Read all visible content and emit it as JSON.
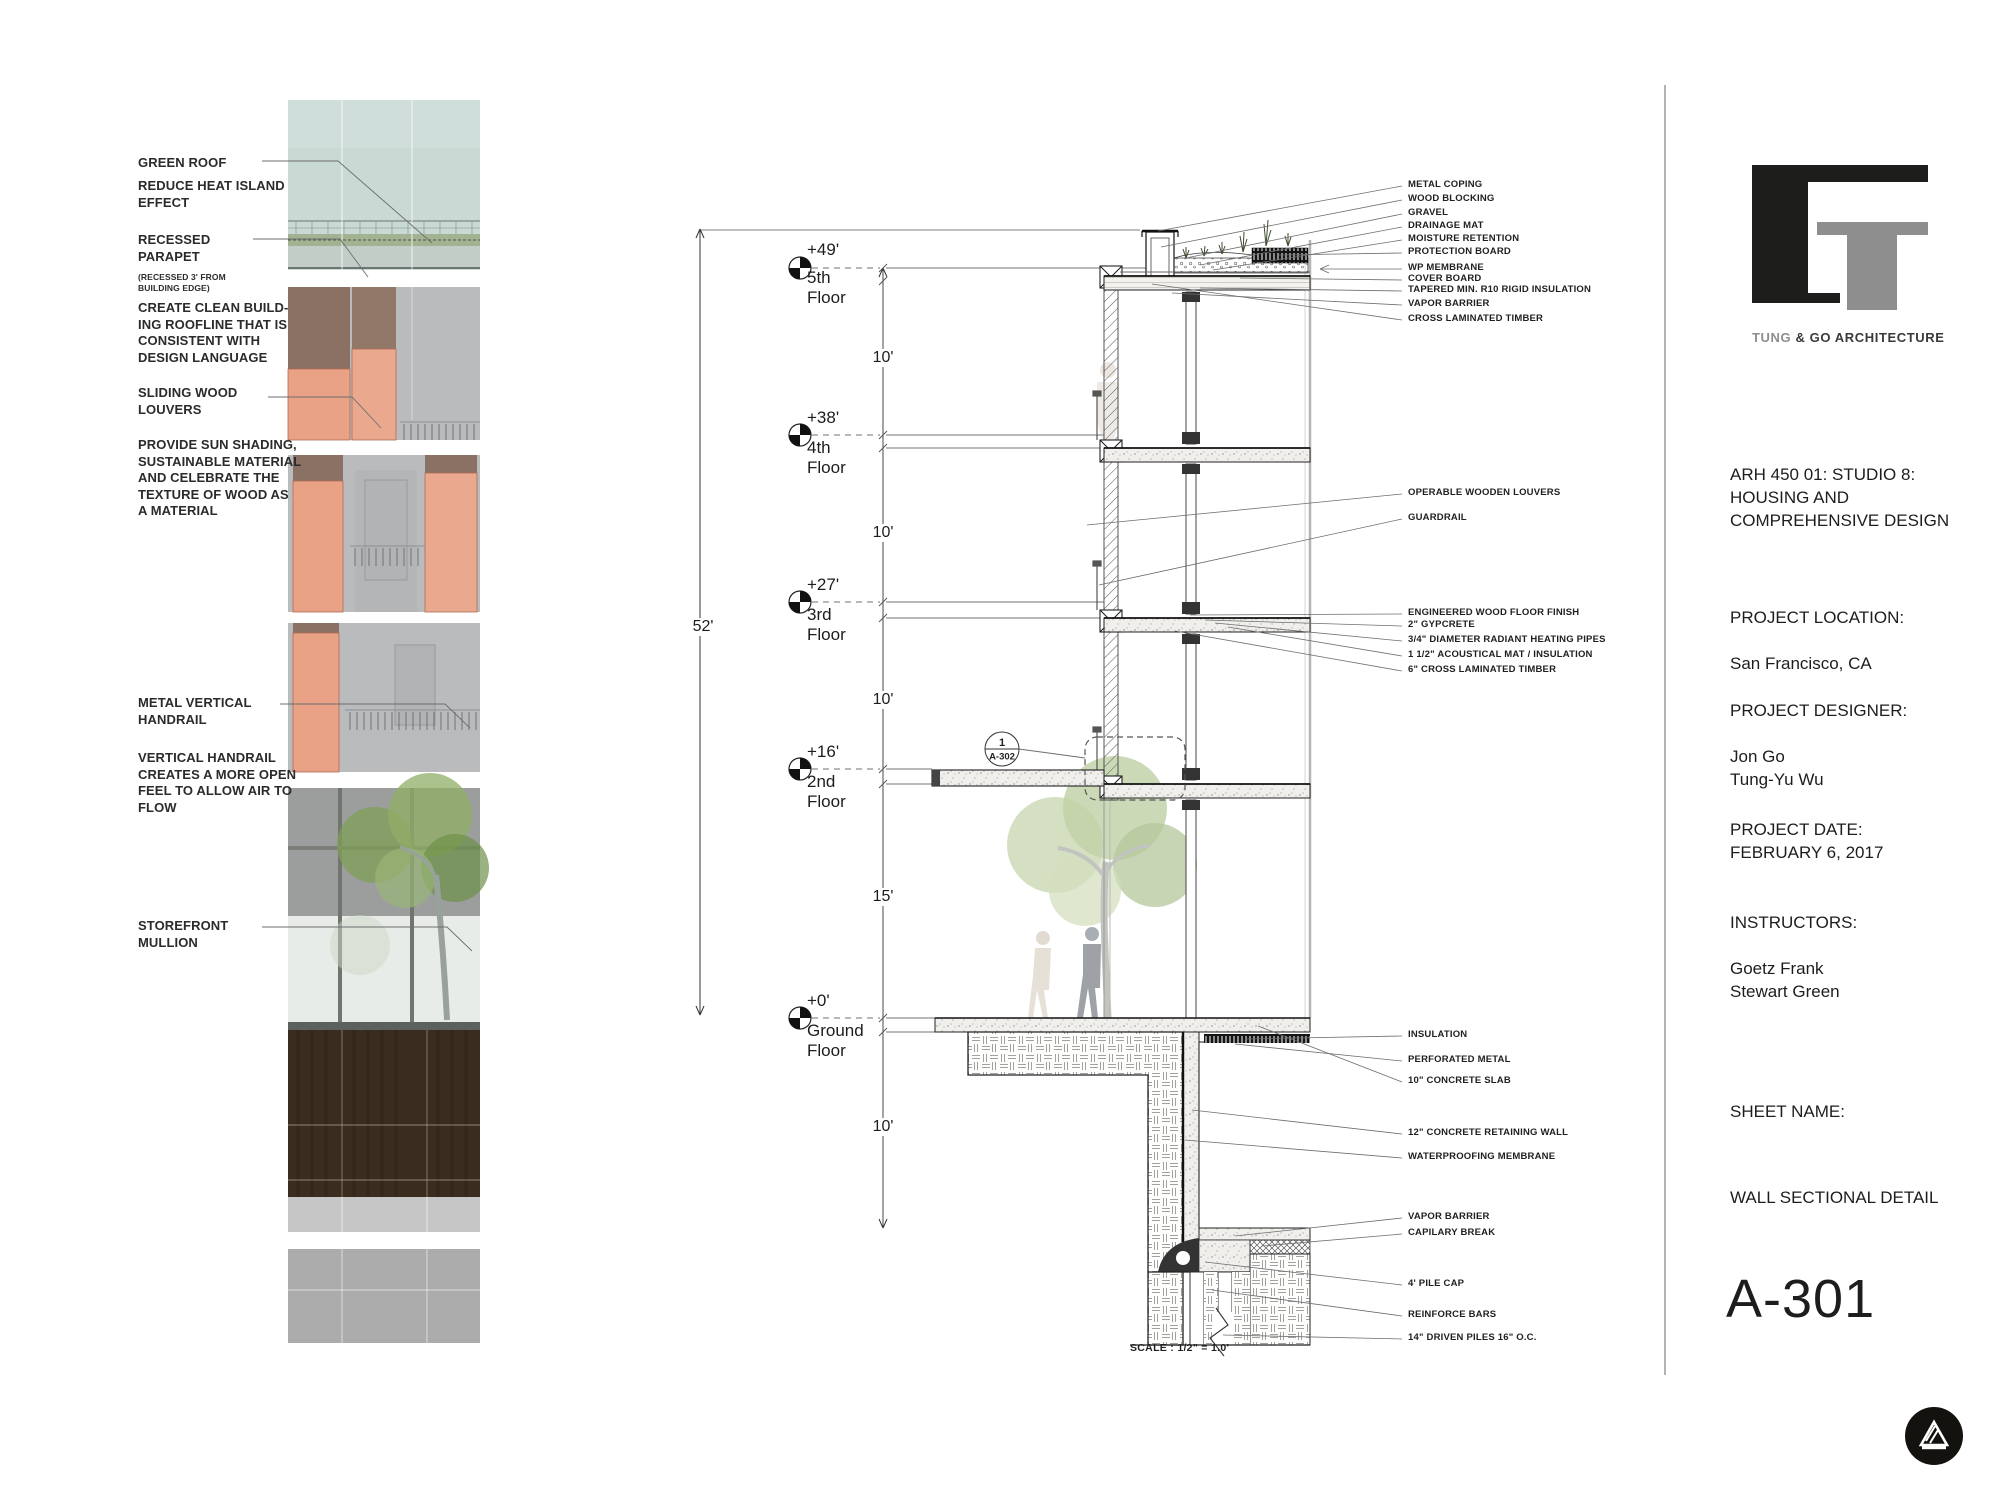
{
  "left_annotations": [
    "GREEN ROOF",
    "REDUCE HEAT ISLAND\nEFFECT",
    "RECESSED\nPARAPET",
    "(RECESSED 3' FROM\nBUILDING EDGE)",
    "CREATE CLEAN BUILD-\nING ROOFLINE THAT IS\nCONSISTENT WITH\nDESIGN LANGUAGE",
    "SLIDING WOOD\nLOUVERS",
    "PROVIDE SUN SHADING,\nSUSTAINABLE MATERIAL\nAND CELEBRATE THE\nTEXTURE OF WOOD AS\nA MATERIAL",
    "METAL VERTICAL\nHANDRAIL",
    "VERTICAL HANDRAIL\nCREATES A MORE OPEN\nFEEL TO ALLOW AIR TO\nFLOW",
    "STOREFRONT\nMULLION"
  ],
  "levels": [
    {
      "elev": "+49'",
      "name": "5th\nFloor"
    },
    {
      "elev": "+38'",
      "name": "4th\nFloor"
    },
    {
      "elev": "+27'",
      "name": "3rd\nFloor"
    },
    {
      "elev": "+16'",
      "name": "2nd\nFloor"
    },
    {
      "elev": "+0'",
      "name": "Ground\nFloor"
    }
  ],
  "dims": {
    "overall": "52'",
    "story": [
      "10'",
      "10'",
      "10'",
      "15'"
    ],
    "below_grade": "10'"
  },
  "detail_bubble": {
    "number": "1",
    "sheet": "A-302"
  },
  "callouts": {
    "roof": [
      "METAL COPING",
      "WOOD BLOCKING",
      "GRAVEL",
      "DRAINAGE MAT",
      "MOISTURE RETENTION",
      "PROTECTION BOARD",
      "WP MEMBRANE",
      "COVER BOARD",
      "TAPERED MIN. R10 RIGID INSULATION",
      "VAPOR BARRIER",
      "CROSS LAMINATED TIMBER"
    ],
    "mid": [
      "OPERABLE WOODEN LOUVERS",
      "GUARDRAIL"
    ],
    "floor": [
      "ENGINEERED WOOD FLOOR FINISH",
      "2\" GYPCRETE",
      "3/4\" DIAMETER RADIANT HEATING PIPES",
      "1 1/2\" ACOUSTICAL MAT / INSULATION",
      "6\" CROSS LAMINATED TIMBER"
    ],
    "foundation": [
      "INSULATION",
      "PERFORATED METAL",
      "10\" CONCRETE SLAB",
      "12\" CONCRETE RETAINING WALL",
      "WATERPROOFING MEMBRANE",
      "VAPOR BARRIER",
      "CAPILARY BREAK",
      "4' PILE CAP",
      "REINFORCE BARS",
      "14\" DRIVEN PILES 16\" O.C."
    ]
  },
  "scale_note": "SCALE : 1/2\" = 1.0'",
  "title_block": {
    "firm_gray": "TUNG",
    "firm_dark": " & GO ARCHITECTURE",
    "course": "ARH 450 01: STUDIO 8:\nHOUSING AND\nCOMPREHENSIVE DESIGN",
    "project_location_label": "PROJECT LOCATION:",
    "project_location": "San Francisco, CA",
    "project_designer_label": "PROJECT DESIGNER:",
    "designers": "Jon Go\nTung-Yu Wu",
    "project_date_label": "PROJECT DATE:",
    "project_date": "FEBRUARY 6, 2017",
    "instructors_label": "INSTRUCTORS:",
    "instructors": "Goetz Frank\nStewart Green",
    "sheet_name_label": "SHEET NAME:",
    "sheet_name": "WALL SECTIONAL DETAIL",
    "sheet_number": "A-301"
  },
  "colors": {
    "louver_orange": "#E9A286",
    "facade_brown": "#8A7164",
    "panel_gray": "#B9BABC",
    "green_roof": "#C9DAD5",
    "glass": "#E7ECE8",
    "dark_wood": "#3A2C1E",
    "ink": "#231F20",
    "leader_gray": "#6D6E70"
  }
}
